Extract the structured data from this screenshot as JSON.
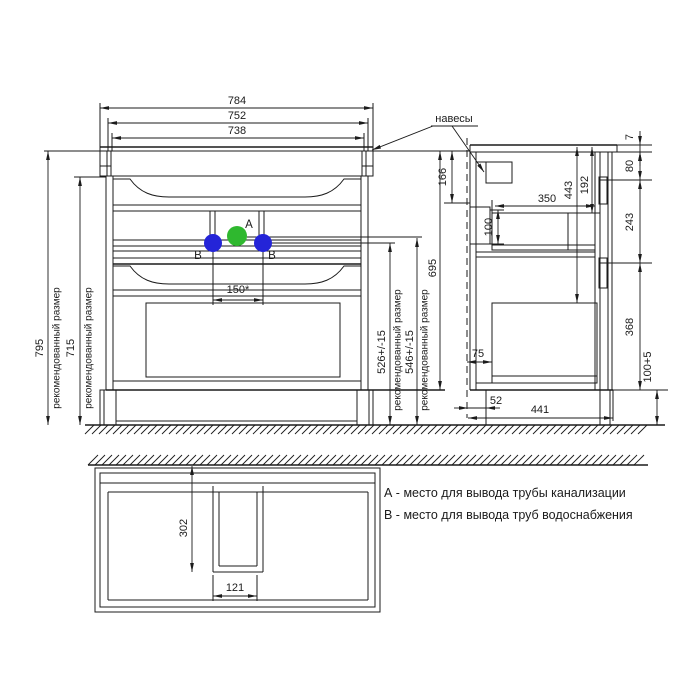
{
  "colors": {
    "background": "#ffffff",
    "ink": "#1b1b1b",
    "point_a": "#2fb82f",
    "point_b": "#2424d8"
  },
  "front_view": {
    "note_recommended": "рекомендованный размер",
    "dims": {
      "width_784": "784",
      "width_752": "752",
      "width_738": "738",
      "height_795": "795",
      "height_715": "715",
      "pipe_spacing_150": "150*",
      "height_526": "526+/-15",
      "height_546": "546+/-15",
      "height_695": "695"
    },
    "points": {
      "a_label": "A",
      "b_label": "B"
    }
  },
  "side_view": {
    "hangers_label": "навесы",
    "dims": {
      "d166": "166",
      "d100": "100",
      "d350": "350",
      "d443": "443",
      "d192": "192",
      "d7": "7",
      "d80": "80",
      "d243": "243",
      "d368": "368",
      "d100_5": "100+5",
      "d75": "75",
      "d52": "52",
      "d441": "441"
    }
  },
  "plan_view": {
    "dims": {
      "d302": "302",
      "d121": "121"
    }
  },
  "legend": {
    "line_a": "А - место для вывода трубы канализации",
    "line_b": "В - место для вывода труб водоснабжения"
  }
}
